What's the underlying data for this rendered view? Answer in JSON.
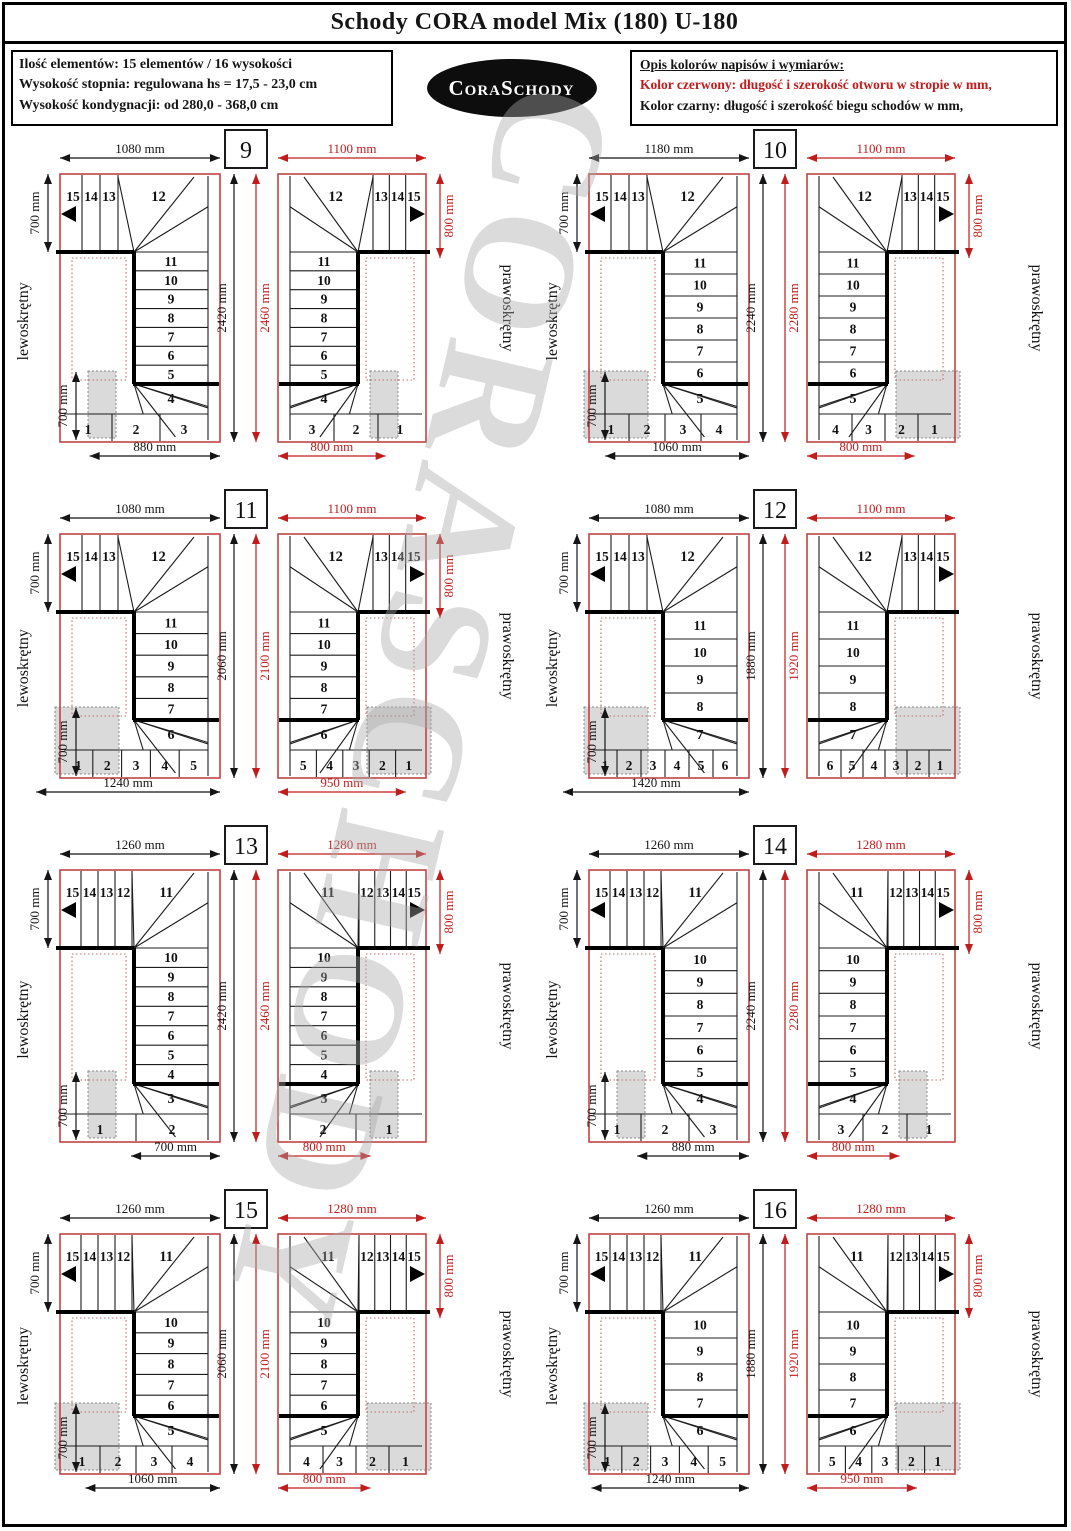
{
  "header": {
    "title": "Schody CORA model Mix (180) U-180",
    "info_lines": [
      "Ilość elementów: 15 elementów / 16 wysokości",
      "Wysokość stopnia: regulowana  hs = 17,5 - 23,0 cm",
      "Wysokość kondygnacji: od 280,0 - 368,0 cm"
    ],
    "logo_text": "CoraSchody",
    "legend": {
      "title": "Opis kolorów napisów i wymiarów:",
      "red_line": "Kolor czerwony: długość i szerokość otworu w stropie w mm,",
      "black_line": "Kolor czarny: długość i szerokość biegu schodów w mm,"
    }
  },
  "side_labels": {
    "left": "lewoskrętny",
    "right": "prawoskrętny"
  },
  "watermark": "CORASCHODY",
  "colors": {
    "red": "#c11c1c",
    "black": "#151515",
    "frame": "#bf4444",
    "shade": "#dadada"
  },
  "variants": [
    {
      "id": "9",
      "dims": {
        "top_black": "1080 mm",
        "top_red": "1100 mm",
        "vert_black": "2420 mm",
        "vert_red": "2460 mm",
        "bottom_black": "880 mm",
        "bottom_red": "800 mm",
        "left_top": "700 mm",
        "left_bottom": "700 mm",
        "right_red": "800 mm"
      },
      "steps": {
        "top_cols": [
          15,
          14,
          13
        ],
        "top_fan": 12,
        "flight": [
          11,
          10,
          9,
          8,
          7,
          6,
          5
        ],
        "bottom_fan": 4,
        "bottom_row": [
          1,
          2,
          3
        ]
      },
      "shaded": 1
    },
    {
      "id": "10",
      "dims": {
        "top_black": "1180 mm",
        "top_red": "1100 mm",
        "vert_black": "2240 mm",
        "vert_red": "2280 mm",
        "bottom_black": "1060 mm",
        "bottom_red": "800 mm",
        "left_top": "700 mm",
        "left_bottom": "700 mm",
        "right_red": "800 mm"
      },
      "steps": {
        "top_cols": [
          15,
          14,
          13
        ],
        "top_fan": 12,
        "flight": [
          11,
          10,
          9,
          8,
          7,
          6
        ],
        "bottom_fan": 5,
        "bottom_row": [
          1,
          2,
          3,
          4
        ]
      },
      "shaded": 2
    },
    {
      "id": "11",
      "dims": {
        "top_black": "1080 mm",
        "top_red": "1100 mm",
        "vert_black": "2060 mm",
        "vert_red": "2100 mm",
        "bottom_black": "1240 mm",
        "bottom_red": "950 mm",
        "left_top": "700 mm",
        "left_bottom": "700 mm",
        "right_red": "800 mm"
      },
      "steps": {
        "top_cols": [
          15,
          14,
          13
        ],
        "top_fan": 12,
        "flight": [
          11,
          10,
          9,
          8,
          7
        ],
        "bottom_fan": 6,
        "bottom_row": [
          1,
          2,
          3,
          4,
          5
        ]
      },
      "shaded": 2
    },
    {
      "id": "12",
      "dims": {
        "top_black": "1080 mm",
        "top_red": "1100 mm",
        "vert_black": "1880 mm",
        "vert_red": "1920 mm",
        "bottom_black": "1420 mm",
        "bottom_red": null,
        "left_top": "700 mm",
        "left_bottom": "700 mm",
        "right_red": null
      },
      "steps": {
        "top_cols": [
          15,
          14,
          13
        ],
        "top_fan": 12,
        "flight": [
          11,
          10,
          9,
          8
        ],
        "bottom_fan": 7,
        "bottom_row": [
          1,
          2,
          3,
          4,
          5,
          6
        ]
      },
      "shaded": 2
    },
    {
      "id": "13",
      "dims": {
        "top_black": "1260 mm",
        "top_red": "1280 mm",
        "vert_black": "2420 mm",
        "vert_red": "2460 mm",
        "bottom_black": "700 mm",
        "bottom_red": "800 mm",
        "left_top": "700 mm",
        "left_bottom": "700 mm",
        "right_red": "800 mm"
      },
      "steps": {
        "top_cols": [
          15,
          14,
          13,
          12
        ],
        "top_fan": 11,
        "flight": [
          10,
          9,
          8,
          7,
          6,
          5,
          4
        ],
        "bottom_fan": 3,
        "bottom_row": [
          1,
          2
        ]
      },
      "shaded": 1
    },
    {
      "id": "14",
      "dims": {
        "top_black": "1260 mm",
        "top_red": "1280 mm",
        "vert_black": "2240 mm",
        "vert_red": "2280 mm",
        "bottom_black": "880 mm",
        "bottom_red": "800 mm",
        "left_top": "700 mm",
        "left_bottom": "700 mm",
        "right_red": "800 mm"
      },
      "steps": {
        "top_cols": [
          15,
          14,
          13,
          12
        ],
        "top_fan": 11,
        "flight": [
          10,
          9,
          8,
          7,
          6,
          5
        ],
        "bottom_fan": 4,
        "bottom_row": [
          1,
          2,
          3
        ]
      },
      "shaded": 1
    },
    {
      "id": "15",
      "dims": {
        "top_black": "1260 mm",
        "top_red": "1280 mm",
        "vert_black": "2060 mm",
        "vert_red": "2100 mm",
        "bottom_black": "1060 mm",
        "bottom_red": "800 mm",
        "left_top": "700 mm",
        "left_bottom": "700 mm",
        "right_red": "800 mm"
      },
      "steps": {
        "top_cols": [
          15,
          14,
          13,
          12
        ],
        "top_fan": 11,
        "flight": [
          10,
          9,
          8,
          7,
          6
        ],
        "bottom_fan": 5,
        "bottom_row": [
          1,
          2,
          3,
          4
        ]
      },
      "shaded": 2
    },
    {
      "id": "16",
      "dims": {
        "top_black": "1260 mm",
        "top_red": "1280 mm",
        "vert_black": "1880 mm",
        "vert_red": "1920 mm",
        "bottom_black": "1240 mm",
        "bottom_red": "950 mm",
        "left_top": "700 mm",
        "left_bottom": "700 mm",
        "right_red": "800 mm"
      },
      "steps": {
        "top_cols": [
          15,
          14,
          13,
          12
        ],
        "top_fan": 11,
        "flight": [
          10,
          9,
          8,
          7
        ],
        "bottom_fan": 6,
        "bottom_row": [
          1,
          2,
          3,
          4,
          5
        ]
      },
      "shaded": 2
    }
  ]
}
